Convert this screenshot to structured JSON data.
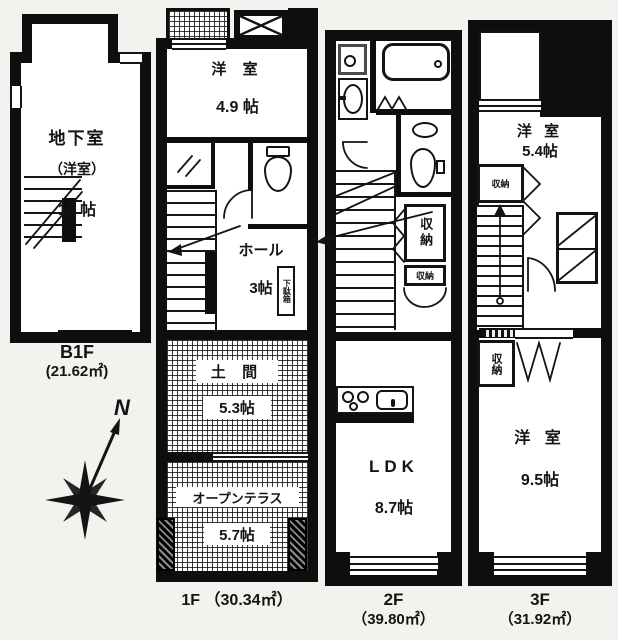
{
  "b1f": {
    "room_name": "地下室",
    "room_name2": "（洋室）",
    "room_size": "13 帖",
    "floor_label": "B1F",
    "floor_area": "(21.62㎡)"
  },
  "f1": {
    "bedroom_name": "洋 室",
    "bedroom_size": "4.9 帖",
    "hall_name": "ホール",
    "hall_size": "3帖",
    "shoe_cabinet": "下駄箱",
    "doma_name": "土 間",
    "doma_size": "5.3帖",
    "terrace_name": "オープンテラス",
    "terrace_size": "5.7帖",
    "floor_label": "1F （30.34㎡）"
  },
  "f2": {
    "storage_tall": "収納",
    "storage_small": "収納",
    "ldk_name": "LDK",
    "ldk_size": "8.7帖",
    "floor_label": "2F",
    "floor_area": "（39.80㎡）"
  },
  "f3": {
    "bedroom1_name": "洋 室",
    "bedroom1_size": "5.4帖",
    "storage_top": "収納",
    "storage_bottom": "収納",
    "bedroom2_name": "洋 室",
    "bedroom2_size": "9.5帖",
    "floor_label": "3F",
    "floor_area": "（31.92㎡）"
  },
  "compass": {
    "north": "N"
  },
  "colors": {
    "wall": "#0e0e0e",
    "paper": "#f2f2ef",
    "room": "#ffffff"
  }
}
